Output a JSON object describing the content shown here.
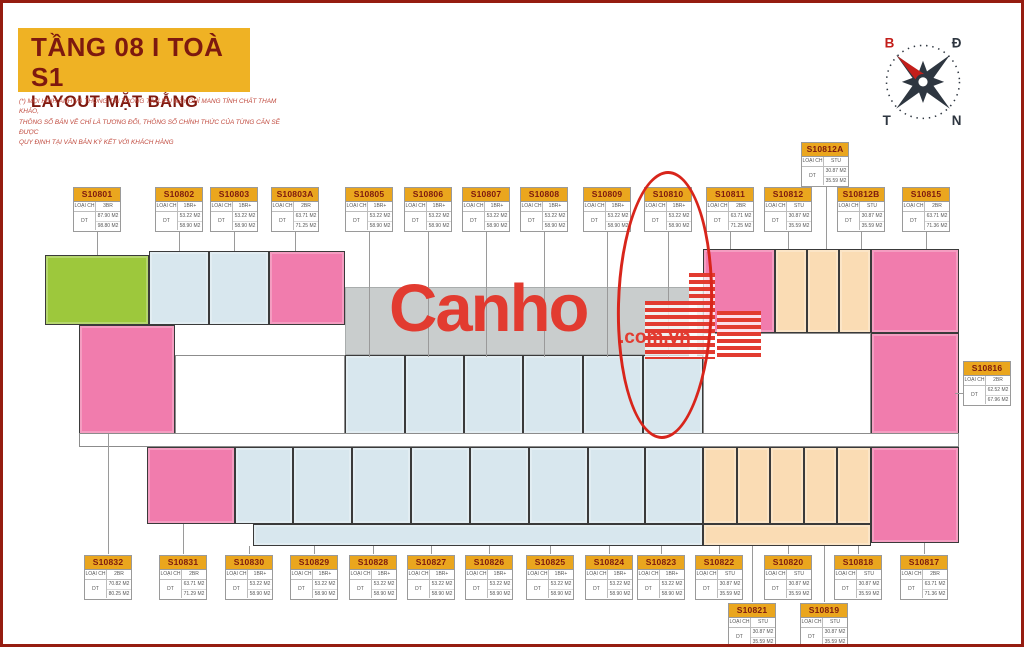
{
  "header": {
    "title_line1": "TẦNG 08  I  TOÀ S1",
    "title_line2": "LAYOUT MẶT BẰNG",
    "disclaimer_lines": [
      "(*) MỌI HÌNH ẢNH VÀ THÔNG TIN TRONG TÀI LIỆU NÀY CHỈ MANG TÍNH CHẤT THAM KHẢO,",
      "THÔNG SỐ BẢN VẼ CHỈ LÀ TƯƠNG ĐỐI, THÔNG SỐ CHÍNH THỨC CỦA TỪNG CĂN SẼ ĐƯỢC",
      "QUY ĐỊNH TẠI VĂN BẢN KÝ KẾT VỚI KHÁCH HÀNG"
    ]
  },
  "compass": {
    "north_label": "B",
    "east_label": "Đ",
    "west_label": "T",
    "south_label": "N",
    "needle_color": "#c31e1a",
    "star_color": "#2e3640"
  },
  "watermark": {
    "brand": "Canho",
    "suffix": ".com.vn",
    "color": "#e23b30"
  },
  "card_labels": {
    "type": "LOẠI CH",
    "area": "DT"
  },
  "palette": {
    "studio": "#fadcb4",
    "one_br": "#d8e7ee",
    "two_br": "#f17cad",
    "three_br": "#9dc83c",
    "terrace": "#c9cdcd",
    "core": "#ffffff",
    "accent_yellow": "#efb224",
    "accent_darkred": "#7d190f",
    "annotation_red": "#d8251b"
  },
  "annotation": {
    "highlight_unit": "S10810",
    "x": 614,
    "y": 168,
    "w": 96,
    "h": 268
  },
  "units": [
    {
      "id": "S10801",
      "type": "3BR",
      "areas": [
        "87.90 M2",
        "98.80 M2"
      ],
      "card": {
        "x": 70,
        "y": 184
      },
      "leader": {
        "x": 94,
        "y1": 229,
        "y2": 252
      }
    },
    {
      "id": "S10802",
      "type": "1BR+",
      "areas": [
        "53.22 M2",
        "58.90 M2"
      ],
      "card": {
        "x": 152,
        "y": 184
      },
      "leader": {
        "x": 176,
        "y1": 229,
        "y2": 248
      }
    },
    {
      "id": "S10803",
      "type": "1BR+",
      "areas": [
        "53.22 M2",
        "58.90 M2"
      ],
      "card": {
        "x": 207,
        "y": 184
      },
      "leader": {
        "x": 231,
        "y1": 229,
        "y2": 248
      }
    },
    {
      "id": "S10803A",
      "type": "2BR",
      "areas": [
        "63.71 M2",
        "71.25 M2"
      ],
      "card": {
        "x": 268,
        "y": 184
      },
      "leader": {
        "x": 292,
        "y1": 229,
        "y2": 248
      }
    },
    {
      "id": "S10805",
      "type": "1BR+",
      "areas": [
        "53.22 M2",
        "58.90 M2"
      ],
      "card": {
        "x": 342,
        "y": 184
      },
      "leader": {
        "x": 366,
        "y1": 229,
        "y2": 354
      }
    },
    {
      "id": "S10806",
      "type": "1BR+",
      "areas": [
        "53.22 M2",
        "58.90 M2"
      ],
      "card": {
        "x": 401,
        "y": 184
      },
      "leader": {
        "x": 425,
        "y1": 229,
        "y2": 354
      }
    },
    {
      "id": "S10807",
      "type": "1BR+",
      "areas": [
        "53.22 M2",
        "58.90 M2"
      ],
      "card": {
        "x": 459,
        "y": 184
      },
      "leader": {
        "x": 483,
        "y1": 229,
        "y2": 354
      }
    },
    {
      "id": "S10808",
      "type": "1BR+",
      "areas": [
        "53.22 M2",
        "58.90 M2"
      ],
      "card": {
        "x": 517,
        "y": 184
      },
      "leader": {
        "x": 541,
        "y1": 229,
        "y2": 354
      }
    },
    {
      "id": "S10809",
      "type": "1BR+",
      "areas": [
        "53.22 M2",
        "58.90 M2"
      ],
      "card": {
        "x": 580,
        "y": 184
      },
      "leader": {
        "x": 604,
        "y1": 229,
        "y2": 354
      }
    },
    {
      "id": "S10810",
      "type": "1BR+",
      "areas": [
        "53.22 M2",
        "58.90 M2"
      ],
      "card": {
        "x": 641,
        "y": 184
      },
      "leader": {
        "x": 665,
        "y1": 229,
        "y2": 354
      }
    },
    {
      "id": "S10811",
      "type": "2BR",
      "areas": [
        "63.71 M2",
        "71.25 M2"
      ],
      "card": {
        "x": 703,
        "y": 184
      },
      "leader": {
        "x": 727,
        "y1": 229,
        "y2": 246
      }
    },
    {
      "id": "S10812",
      "type": "STU",
      "areas": [
        "30.87 M2",
        "35.59 M2"
      ],
      "card": {
        "x": 761,
        "y": 184
      },
      "leader": {
        "x": 785,
        "y1": 229,
        "y2": 246
      }
    },
    {
      "id": "S10812A",
      "type": "STU",
      "areas": [
        "30.87 M2",
        "35.59 M2"
      ],
      "card": {
        "x": 798,
        "y": 139
      },
      "leader": {
        "x": 823,
        "y1": 184,
        "y2": 246
      }
    },
    {
      "id": "S10812B",
      "type": "STU",
      "areas": [
        "30.87 M2",
        "35.59 M2"
      ],
      "card": {
        "x": 834,
        "y": 184
      },
      "leader": {
        "x": 858,
        "y1": 229,
        "y2": 246
      }
    },
    {
      "id": "S10815",
      "type": "2BR",
      "areas": [
        "63.71 M2",
        "71.36 M2"
      ],
      "card": {
        "x": 899,
        "y": 184
      },
      "leader": {
        "x": 923,
        "y1": 229,
        "y2": 246
      }
    },
    {
      "id": "S10816",
      "type": "2BR",
      "areas": [
        "62.52 M2",
        "67.96 M2"
      ],
      "card": {
        "x": 960,
        "y": 358
      },
      "leader": {
        "y": 390,
        "x1": 952,
        "x2": 960
      }
    },
    {
      "id": "S10832",
      "type": "2BR",
      "areas": [
        "70.82 M2",
        "80.25 M2"
      ],
      "card": {
        "x": 81,
        "y": 552
      },
      "leader": {
        "x": 105,
        "y1": 431,
        "y2": 551
      }
    },
    {
      "id": "S10831",
      "type": "2BR",
      "areas": [
        "63.71 M2",
        "71.29 M2"
      ],
      "card": {
        "x": 156,
        "y": 552
      },
      "leader": {
        "x": 180,
        "y1": 521,
        "y2": 551
      }
    },
    {
      "id": "S10830",
      "type": "1BR+",
      "areas": [
        "53.22 M2",
        "58.90 M2"
      ],
      "card": {
        "x": 222,
        "y": 552
      },
      "leader": {
        "x": 246,
        "y1": 543,
        "y2": 551
      }
    },
    {
      "id": "S10829",
      "type": "1BR+",
      "areas": [
        "53.22 M2",
        "58.90 M2"
      ],
      "card": {
        "x": 287,
        "y": 552
      },
      "leader": {
        "x": 311,
        "y1": 543,
        "y2": 551
      }
    },
    {
      "id": "S10828",
      "type": "1BR+",
      "areas": [
        "53.22 M2",
        "58.90 M2"
      ],
      "card": {
        "x": 346,
        "y": 552
      },
      "leader": {
        "x": 370,
        "y1": 543,
        "y2": 551
      }
    },
    {
      "id": "S10827",
      "type": "1BR+",
      "areas": [
        "53.22 M2",
        "58.90 M2"
      ],
      "card": {
        "x": 404,
        "y": 552
      },
      "leader": {
        "x": 428,
        "y1": 543,
        "y2": 551
      }
    },
    {
      "id": "S10826",
      "type": "1BR+",
      "areas": [
        "53.22 M2",
        "58.90 M2"
      ],
      "card": {
        "x": 462,
        "y": 552
      },
      "leader": {
        "x": 486,
        "y1": 543,
        "y2": 551
      }
    },
    {
      "id": "S10825",
      "type": "1BR+",
      "areas": [
        "53.22 M2",
        "58.90 M2"
      ],
      "card": {
        "x": 523,
        "y": 552
      },
      "leader": {
        "x": 547,
        "y1": 543,
        "y2": 551
      }
    },
    {
      "id": "S10824",
      "type": "1BR+",
      "areas": [
        "53.22 M2",
        "58.90 M2"
      ],
      "card": {
        "x": 582,
        "y": 552
      },
      "leader": {
        "x": 606,
        "y1": 543,
        "y2": 551
      }
    },
    {
      "id": "S10823",
      "type": "1BR+",
      "areas": [
        "53.22 M2",
        "58.90 M2"
      ],
      "card": {
        "x": 634,
        "y": 552
      },
      "leader": {
        "x": 658,
        "y1": 543,
        "y2": 551
      }
    },
    {
      "id": "S10822",
      "type": "STU",
      "areas": [
        "30.87 M2",
        "35.59 M2"
      ],
      "card": {
        "x": 692,
        "y": 552
      },
      "leader": {
        "x": 716,
        "y1": 543,
        "y2": 551
      }
    },
    {
      "id": "S10820",
      "type": "STU",
      "areas": [
        "30.87 M2",
        "35.59 M2"
      ],
      "card": {
        "x": 761,
        "y": 552
      },
      "leader": {
        "x": 785,
        "y1": 543,
        "y2": 551
      }
    },
    {
      "id": "S10818",
      "type": "STU",
      "areas": [
        "30.87 M2",
        "35.59 M2"
      ],
      "card": {
        "x": 831,
        "y": 552
      },
      "leader": {
        "x": 855,
        "y1": 543,
        "y2": 551
      }
    },
    {
      "id": "S10817",
      "type": "2BR",
      "areas": [
        "63.71 M2",
        "71.36 M2"
      ],
      "card": {
        "x": 897,
        "y": 552
      },
      "leader": {
        "x": 921,
        "y1": 540,
        "y2": 551
      }
    },
    {
      "id": "S10821",
      "type": "STU",
      "areas": [
        "30.87 M2",
        "35.59 M2"
      ],
      "card": {
        "x": 725,
        "y": 600
      },
      "leader": {
        "x": 749,
        "y1": 543,
        "y2": 599
      }
    },
    {
      "id": "S10819",
      "type": "STU",
      "areas": [
        "30.87 M2",
        "35.59 M2"
      ],
      "card": {
        "x": 797,
        "y": 600
      },
      "leader": {
        "x": 821,
        "y1": 543,
        "y2": 599
      }
    }
  ],
  "plan_blocks": [
    {
      "unit": "terrace",
      "color": "terrace",
      "x": 342,
      "y": 284,
      "w": 358,
      "h": 68
    },
    {
      "unit": "S10801",
      "color": "three_br",
      "x": 42,
      "y": 252,
      "w": 104,
      "h": 70
    },
    {
      "unit": "S10802",
      "color": "one_br",
      "x": 146,
      "y": 248,
      "w": 60,
      "h": 74
    },
    {
      "unit": "S10803",
      "color": "one_br",
      "x": 206,
      "y": 248,
      "w": 60,
      "h": 74
    },
    {
      "unit": "S10803A",
      "color": "two_br",
      "x": 266,
      "y": 248,
      "w": 76,
      "h": 74
    },
    {
      "unit": "S10811",
      "color": "two_br",
      "x": 700,
      "y": 246,
      "w": 72,
      "h": 84
    },
    {
      "unit": "S10812",
      "color": "studio",
      "x": 772,
      "y": 246,
      "w": 32,
      "h": 84
    },
    {
      "unit": "S10812A",
      "color": "studio",
      "x": 804,
      "y": 246,
      "w": 32,
      "h": 84
    },
    {
      "unit": "S10812B",
      "color": "studio",
      "x": 836,
      "y": 246,
      "w": 32,
      "h": 84
    },
    {
      "unit": "S10815",
      "color": "two_br",
      "x": 868,
      "y": 246,
      "w": 88,
      "h": 84
    },
    {
      "unit": "S10832",
      "color": "two_br",
      "x": 76,
      "y": 322,
      "w": 96,
      "h": 109
    },
    {
      "unit": "core-left",
      "color": "core",
      "x": 172,
      "y": 352,
      "w": 170,
      "h": 79
    },
    {
      "unit": "S10805",
      "color": "one_br",
      "x": 342,
      "y": 352,
      "w": 60,
      "h": 79
    },
    {
      "unit": "S10806",
      "color": "one_br",
      "x": 402,
      "y": 352,
      "w": 59,
      "h": 79
    },
    {
      "unit": "S10807",
      "color": "one_br",
      "x": 461,
      "y": 352,
      "w": 59,
      "h": 79
    },
    {
      "unit": "S10808",
      "color": "one_br",
      "x": 520,
      "y": 352,
      "w": 60,
      "h": 79
    },
    {
      "unit": "S10809",
      "color": "one_br",
      "x": 580,
      "y": 352,
      "w": 60,
      "h": 79
    },
    {
      "unit": "S10810",
      "color": "one_br",
      "x": 640,
      "y": 352,
      "w": 60,
      "h": 79
    },
    {
      "unit": "core-right",
      "color": "core",
      "x": 700,
      "y": 330,
      "w": 168,
      "h": 101
    },
    {
      "unit": "S10816",
      "color": "two_br",
      "x": 868,
      "y": 330,
      "w": 88,
      "h": 101
    },
    {
      "unit": "corridor",
      "color": "core",
      "x": 76,
      "y": 430,
      "w": 880,
      "h": 14
    },
    {
      "unit": "S10831",
      "color": "two_br",
      "x": 144,
      "y": 444,
      "w": 88,
      "h": 77
    },
    {
      "unit": "S10830",
      "color": "one_br",
      "x": 232,
      "y": 444,
      "w": 58,
      "h": 77
    },
    {
      "unit": "S10829",
      "color": "one_br",
      "x": 290,
      "y": 444,
      "w": 59,
      "h": 77
    },
    {
      "unit": "S10828",
      "color": "one_br",
      "x": 349,
      "y": 444,
      "w": 59,
      "h": 77
    },
    {
      "unit": "S10827",
      "color": "one_br",
      "x": 408,
      "y": 444,
      "w": 59,
      "h": 77
    },
    {
      "unit": "S10826",
      "color": "one_br",
      "x": 467,
      "y": 444,
      "w": 59,
      "h": 77
    },
    {
      "unit": "S10825",
      "color": "one_br",
      "x": 526,
      "y": 444,
      "w": 59,
      "h": 77
    },
    {
      "unit": "S10824",
      "color": "one_br",
      "x": 585,
      "y": 444,
      "w": 57,
      "h": 77
    },
    {
      "unit": "S10823",
      "color": "one_br",
      "x": 642,
      "y": 444,
      "w": 58,
      "h": 77
    },
    {
      "unit": "S10822",
      "color": "studio",
      "x": 700,
      "y": 444,
      "w": 34,
      "h": 77
    },
    {
      "unit": "S10821",
      "color": "studio",
      "x": 734,
      "y": 444,
      "w": 33,
      "h": 77
    },
    {
      "unit": "S10820",
      "color": "studio",
      "x": 767,
      "y": 444,
      "w": 34,
      "h": 77
    },
    {
      "unit": "S10819",
      "color": "studio",
      "x": 801,
      "y": 444,
      "w": 33,
      "h": 77
    },
    {
      "unit": "S10818",
      "color": "studio",
      "x": 834,
      "y": 444,
      "w": 34,
      "h": 77
    },
    {
      "unit": "S10817",
      "color": "two_br",
      "x": 868,
      "y": 444,
      "w": 88,
      "h": 96
    },
    {
      "unit": "ledge-blue",
      "color": "one_br",
      "x": 250,
      "y": 521,
      "w": 450,
      "h": 22
    },
    {
      "unit": "ledge-peach",
      "color": "studio",
      "x": 700,
      "y": 521,
      "w": 168,
      "h": 22
    }
  ]
}
